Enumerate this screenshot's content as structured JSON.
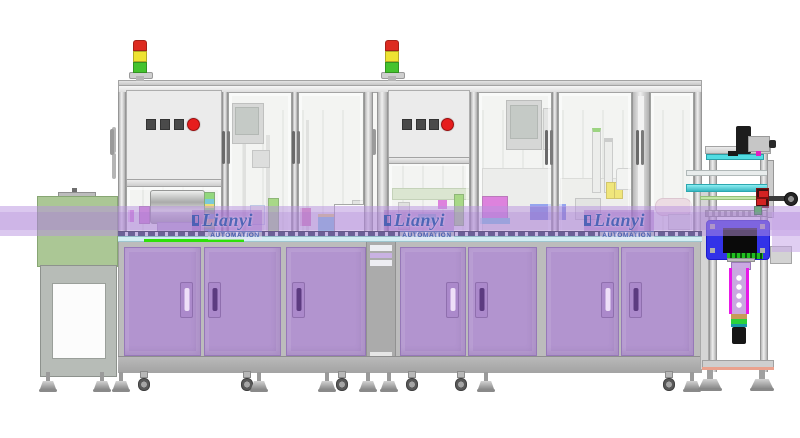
{
  "watermark": {
    "brand": "Lianyi",
    "subtitle": "AUTOMATION",
    "count": 3
  },
  "palette": {
    "cabinet-purple": "#b294cf",
    "conveyor-band": "#b892dd",
    "feeder-green": "#abc795",
    "frame-gray": "#d6d6d6",
    "blue-fixture": "#3232e8",
    "emergency-red": "#e61e1e",
    "tower-red": "#dd2b20",
    "tower-yellow": "#eee332",
    "tower-green": "#44c32e",
    "watermark-blue": "#3c59b0",
    "accent-magenta": "#d23ad2",
    "accent-cyan": "#52dce2",
    "accent-lime": "#2ee00a"
  },
  "signal_towers": [
    {
      "id": "left-tower",
      "segments": [
        "red",
        "yellow",
        "green"
      ]
    },
    {
      "id": "right-tower",
      "segments": [
        "red",
        "yellow",
        "green"
      ]
    }
  ],
  "control_panels": [
    {
      "machine": "left",
      "square_buttons": 3,
      "round_button": "red-emergency"
    },
    {
      "machine": "right",
      "square_buttons": 3,
      "round_button": "red-emergency"
    }
  ]
}
